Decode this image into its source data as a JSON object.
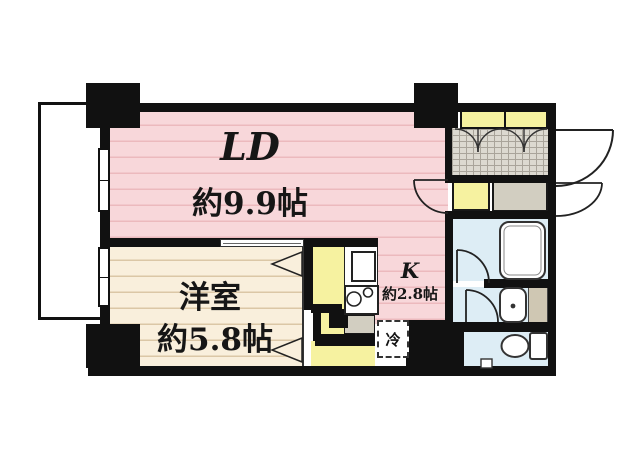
{
  "plan": {
    "rooms": {
      "living_dining": {
        "label": "LD",
        "size": "約9.9帖"
      },
      "western_room": {
        "label": "洋室",
        "size": "約5.8帖"
      },
      "kitchen": {
        "label": "K",
        "size": "約2.8帖"
      }
    },
    "fixtures": {
      "refrigerator_label": "冷"
    },
    "colors": {
      "wall": "#111111",
      "ld-pink": "#f8d7da",
      "ld-stripe": "#ecb9bd",
      "cream": "#f9efdc",
      "cream-stripe": "#dbc7a6",
      "closet-yellow": "#f6f2a0",
      "water-blue": "#ddedf5",
      "cell-grey": "#d2cec1",
      "cell-beige": "#cfc7b3",
      "tile-bg": "#dcd9d0",
      "tile-line": "#a9a49a"
    }
  }
}
